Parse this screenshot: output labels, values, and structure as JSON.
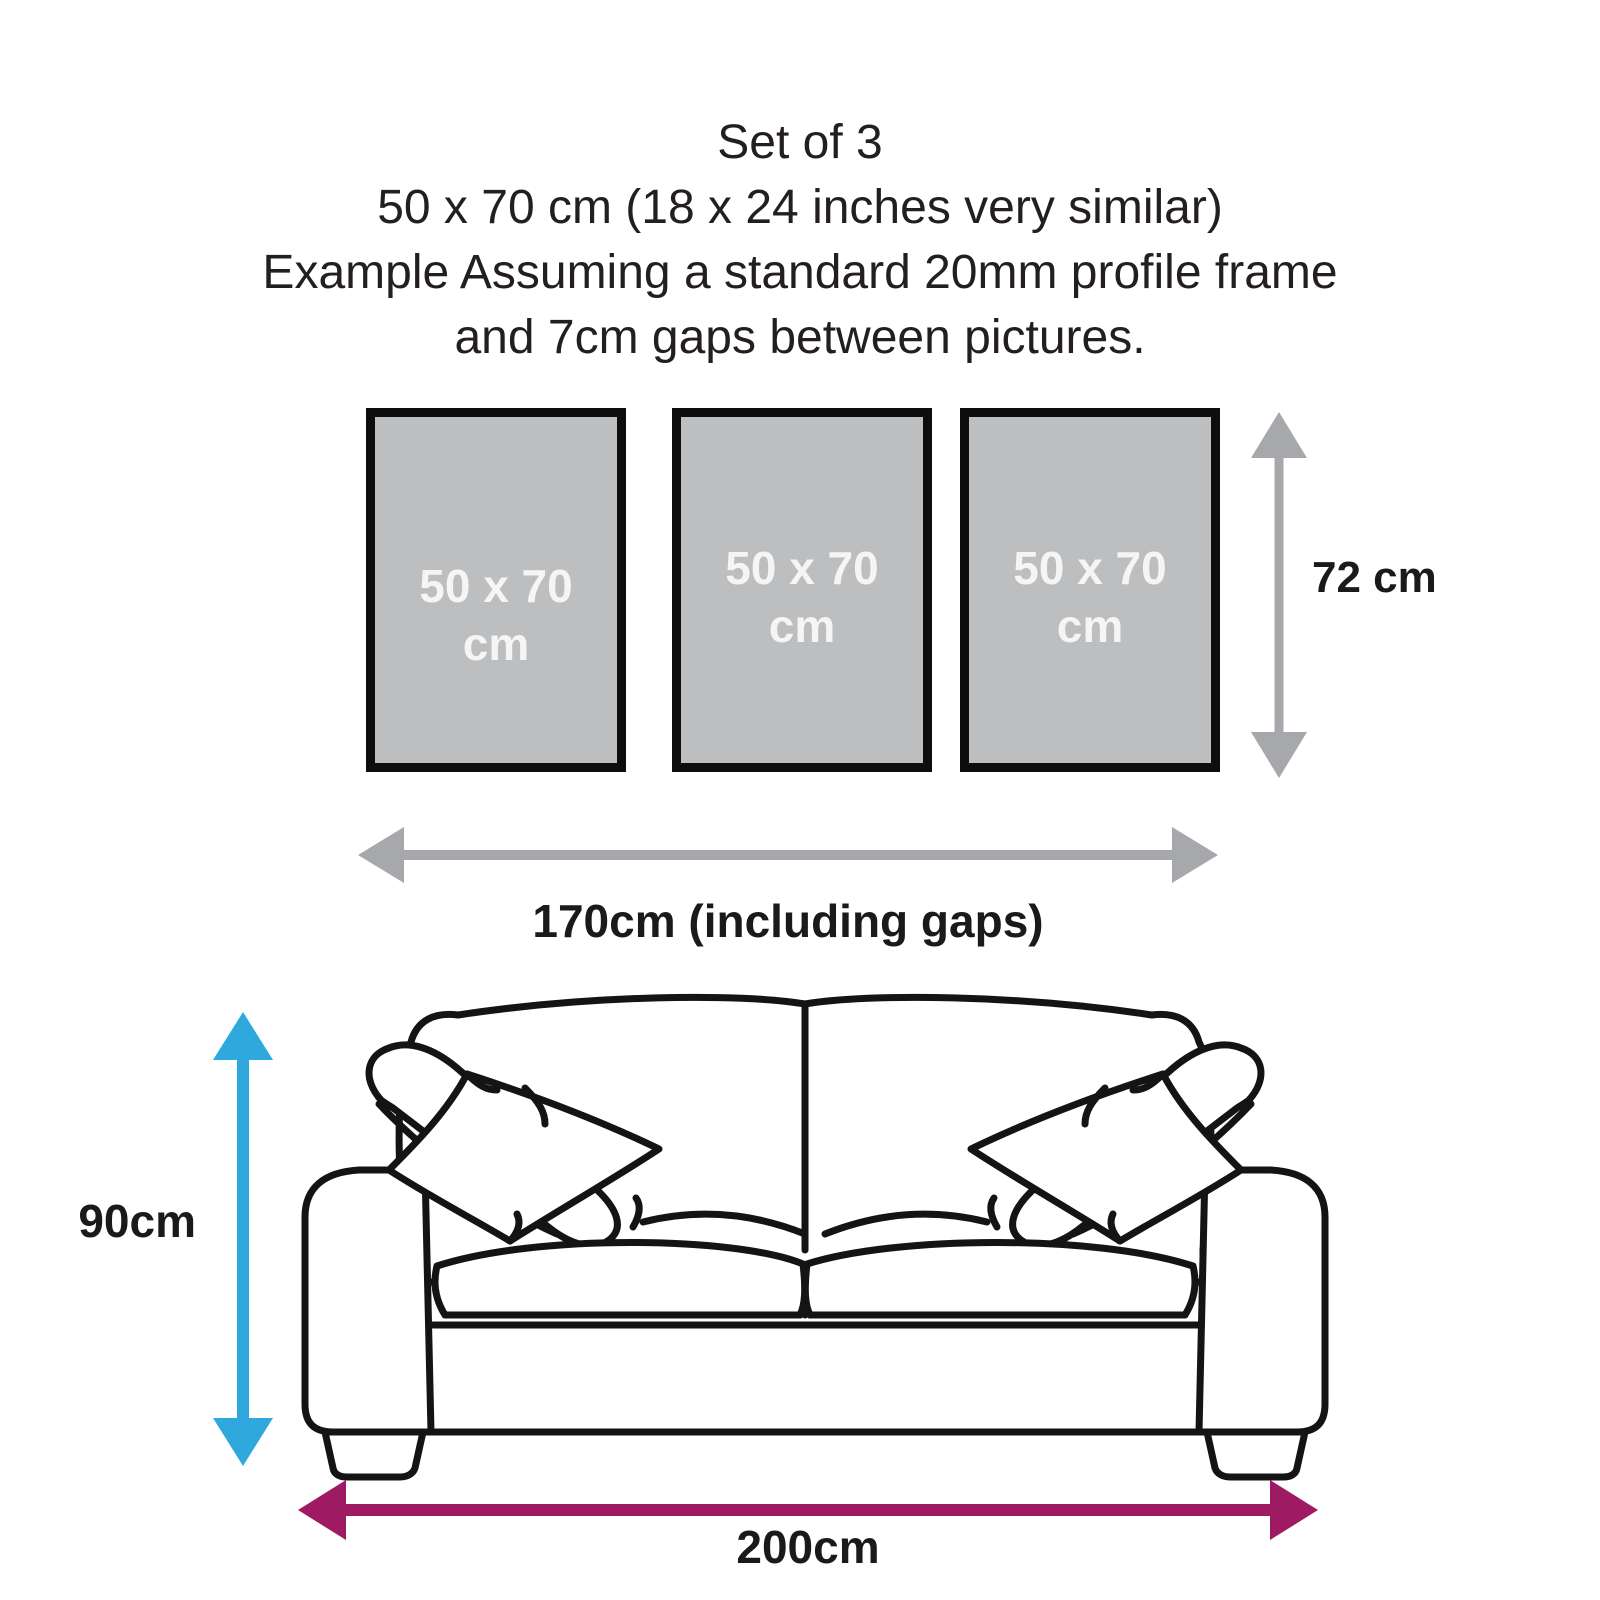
{
  "title": {
    "lines": [
      "Set of 3",
      "50 x 70 cm  (18 x 24 inches very similar)",
      "Example Assuming a standard 20mm profile frame",
      "and 7cm gaps between pictures."
    ]
  },
  "frames": [
    {
      "size": "50 x 70",
      "unit": "cm"
    },
    {
      "size": "50 x 70",
      "unit": "cm"
    },
    {
      "size": "50 x 70",
      "unit": "cm"
    }
  ],
  "dimensions": {
    "frame_height": {
      "label": "72 cm",
      "color": "#a6a8ab"
    },
    "set_width": {
      "label": "170cm (including gaps)",
      "color": "#a6a8ab"
    },
    "sofa_height": {
      "label": "90cm",
      "color": "#2fa8dd"
    },
    "sofa_width": {
      "label": "200cm",
      "color": "#9e1a62"
    }
  },
  "colors": {
    "frame_fill": "#bcbec0",
    "frame_border": "#0d0d0d",
    "frame_label_text": "#f5f5f5",
    "gray_arrow": "#a6a8ab",
    "blue_arrow": "#2fa8dd",
    "purple_arrow": "#9e1a62",
    "sofa_outline": "#141414",
    "text": "#231f20"
  }
}
